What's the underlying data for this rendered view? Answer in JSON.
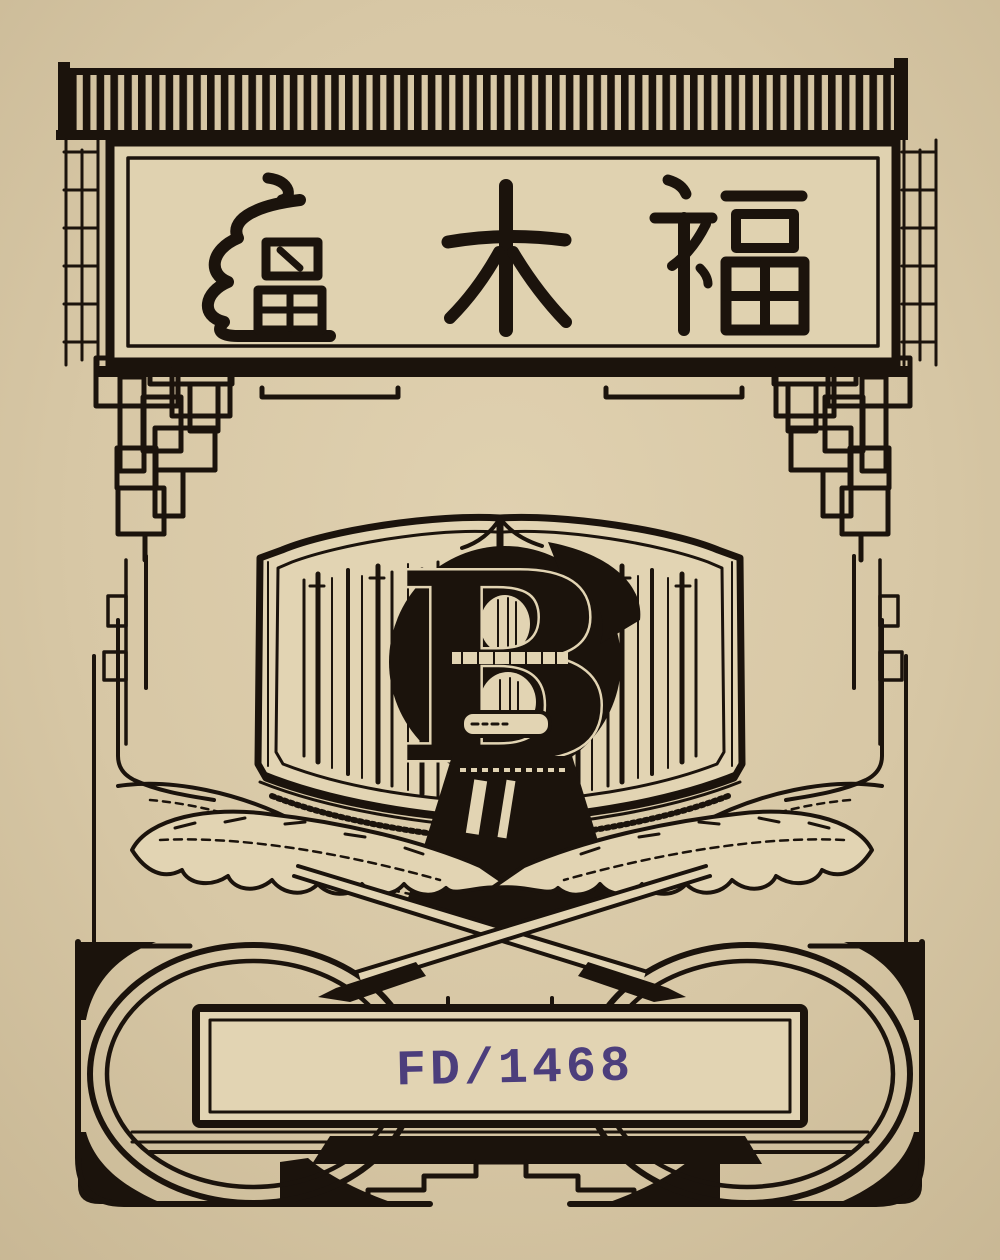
{
  "banner": {
    "characters": "廬木福",
    "char_left": "廬",
    "char_middle": "木",
    "char_right": "福"
  },
  "monogram": {
    "letter": "B"
  },
  "stamp": {
    "text": "FD/1468",
    "color": "#4c3e7c"
  },
  "colors": {
    "paper": "#d7c7a5",
    "paper_light": "#e2d4b3",
    "ink": "#1b130c",
    "stamp": "#4c3e7c"
  },
  "icons": {
    "cornice": "striped-cornice-icon",
    "fretwork": "stepped-fretwork-icon",
    "book": "open-book-icon",
    "monogram": "letter-b-monogram-icon",
    "inkwell": "inkwell-icon",
    "feathers": "crossed-quill-feathers-icon",
    "circles": "ring-ornament-icon"
  }
}
